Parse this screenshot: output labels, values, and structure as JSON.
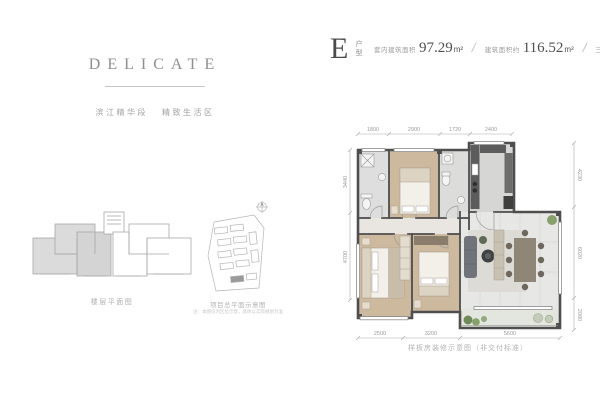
{
  "brand": {
    "title": "DELICATE",
    "tagline_left": "滨江精华段",
    "tagline_right": "精致生活区"
  },
  "unit": {
    "letter": "E",
    "letter_label": "户型",
    "area1_label": "套内建筑面积",
    "area1_value": "97.29",
    "area1_unit": "m²",
    "sep": "/",
    "area2_label": "建筑面积约",
    "area2_value": "116.52",
    "area2_unit": "m²",
    "rooms_label": "三室两厅两卫"
  },
  "key_plan": {
    "caption": "楼层平面图"
  },
  "site_plan": {
    "caption": "项目总平面示意图",
    "note": "注：本图仅为区位示意，具体以实际规划为准"
  },
  "floor_plan": {
    "caption": "样板房装修示意图（非交付标准）",
    "dims_top": [
      "1800",
      "2900",
      "1720",
      "2400"
    ],
    "dims_bottom": [
      "2500",
      "3200",
      "5600"
    ],
    "dims_left": [
      "3440",
      "4700"
    ],
    "dims_right": [
      "4230",
      "6020",
      "2080"
    ]
  },
  "colors": {
    "wood": "#cdb99e",
    "tile": "#dedede",
    "wall": "#4e4e4e",
    "living_floor": "#e7e7e5",
    "accent_green": "#86a06c"
  }
}
